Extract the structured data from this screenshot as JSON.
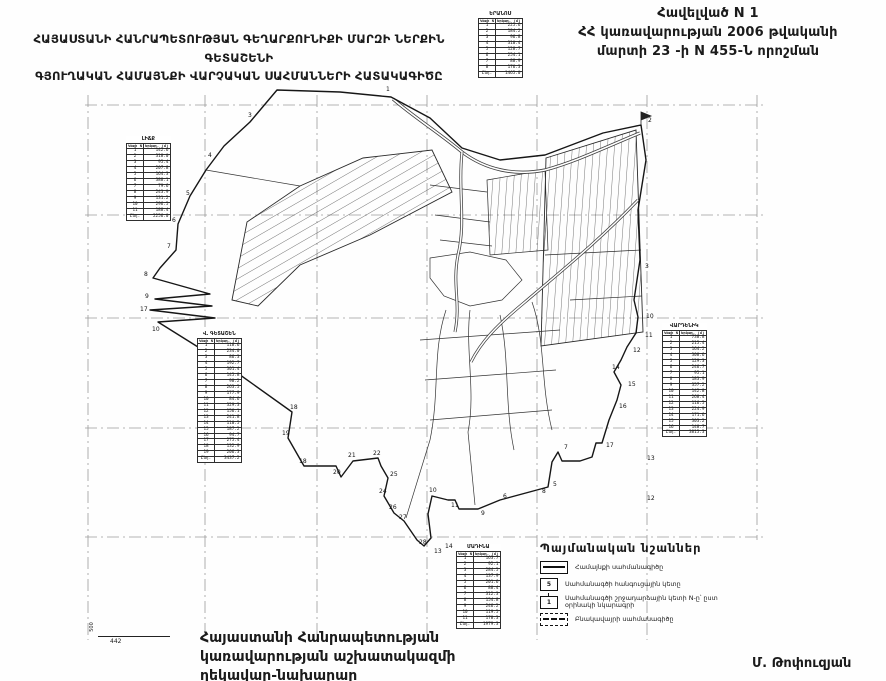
{
  "appendix": {
    "line1": "Հավելված N 1",
    "line2": "ՀՀ կառավարության 2006 թվականի",
    "line3": "մարտի 23 -ի N 455-Ն որոշման"
  },
  "title": {
    "line1": "ՀԱՅԱՍՏԱՆԻ ՀԱՆՐԱՊԵՏՈՒԹՅԱՆ ԳԵՂԱՐՔՈՒՆԻՔԻ ՄԱՐԶԻ ՆԵՐՔԻՆ ԳԵՏԱՇԵՆԻ",
    "line2": "ԳՅՈՒՂԱԿԱՆ ՀԱՄԱՅՆՔԻ ՎԱՐՉԱԿԱՆ  ՍԱՀՄԱՆՆԵՐԻ ՀԱՏԱԿԱԳԻԾԸ"
  },
  "issuer": {
    "line1": "Հայաստանի Հանրապետության",
    "line2": "կառավարության աշխատակազմի",
    "line3": "ղեկավար-նախարար"
  },
  "signature": "Մ. Թոփուզյան",
  "scale": {
    "left_label": "500",
    "bottom_label": "442"
  },
  "legend": {
    "title": "Պայմանական նշաններ",
    "items": [
      {
        "symbol": "boundary-line",
        "sym_text": "",
        "label": "Համայնքի սահմանագիծը"
      },
      {
        "symbol": "node-point",
        "sym_text": "5",
        "label": "Սահմանագծի հանգուցային կետը"
      },
      {
        "symbol": "turn-point",
        "sym_text": "1",
        "label": "Սահմանագծի շրջադարձային կետի N-ը՝ ըստ օրինակի նկարագրի"
      },
      {
        "symbol": "settlement-line",
        "sym_text": "",
        "label": "Բնակավայրի սահմանագիծը"
      }
    ]
  },
  "tables": [
    {
      "id": "north",
      "x": 478,
      "y": 11,
      "title": "ԵՐԱՆՈՍ",
      "col1": "Կետի N",
      "col2": "Երկար. (մ)",
      "rows": [
        [
          "1",
          "225.6"
        ],
        [
          "2",
          "184.2"
        ],
        [
          "3",
          "96.8"
        ],
        [
          "4",
          "310.4"
        ],
        [
          "5",
          "128.7"
        ],
        [
          "6",
          "254.1"
        ],
        [
          "7",
          "88.9"
        ],
        [
          "8",
          "176.3"
        ],
        [
          "Ընդ.",
          "1465.0"
        ]
      ]
    },
    {
      "id": "west",
      "x": 126,
      "y": 136,
      "title": "ԼԻՃՔ",
      "col1": "Կետի N",
      "col2": "Երկար. (մ)",
      "rows": [
        [
          "1",
          "142.6"
        ],
        [
          "2",
          "318.0"
        ],
        [
          "3",
          "95.4"
        ],
        [
          "4",
          "207.8"
        ],
        [
          "5",
          "164.3"
        ],
        [
          "6",
          "388.1"
        ],
        [
          "7",
          "79.6"
        ],
        [
          "8",
          "243.9"
        ],
        [
          "9",
          "131.2"
        ],
        [
          "10",
          "296.5"
        ],
        [
          "11",
          "188.4"
        ],
        [
          "Ընդ.",
          "2256.0"
        ]
      ]
    },
    {
      "id": "southwest",
      "x": 197,
      "y": 331,
      "title": "Վ. ԳԵՏԱՇԵՆ",
      "col1": "Կետի N",
      "col2": "Երկար. (մ)",
      "rows": [
        [
          "1",
          "118.6"
        ],
        [
          "2",
          "234.0"
        ],
        [
          "3",
          "86.3"
        ],
        [
          "4",
          "192.7"
        ],
        [
          "5",
          "301.4"
        ],
        [
          "6",
          "145.8"
        ],
        [
          "7",
          "98.2"
        ],
        [
          "8",
          "263.5"
        ],
        [
          "9",
          "177.9"
        ],
        [
          "10",
          "84.6"
        ],
        [
          "11",
          "329.3"
        ],
        [
          "12",
          "156.1"
        ],
        [
          "13",
          "241.8"
        ],
        [
          "14",
          "110.5"
        ],
        [
          "15",
          "187.2"
        ],
        [
          "16",
          "94.7"
        ],
        [
          "17",
          "275.4"
        ],
        [
          "18",
          "132.9"
        ],
        [
          "19",
          "206.3"
        ],
        [
          "Ընդ.",
          "3437.2"
        ]
      ]
    },
    {
      "id": "east",
      "x": 662,
      "y": 323,
      "title": "ՎԱՐԴԵՆԻԿ",
      "col1": "Կետի N",
      "col2": "Երկար. (մ)",
      "rows": [
        [
          "1",
          "738.8"
        ],
        [
          "2",
          "215.4"
        ],
        [
          "3",
          "164.2"
        ],
        [
          "4",
          "308.6"
        ],
        [
          "5",
          "129.3"
        ],
        [
          "6",
          "246.7"
        ],
        [
          "7",
          "95.1"
        ],
        [
          "8",
          "183.9"
        ],
        [
          "9",
          "357.2"
        ],
        [
          "10",
          "142.8"
        ],
        [
          "11",
          "268.4"
        ],
        [
          "12",
          "116.5"
        ],
        [
          "13",
          "224.9"
        ],
        [
          "14",
          "171.6"
        ],
        [
          "15",
          "303.2"
        ],
        [
          "16",
          "148.7"
        ],
        [
          "Ընդ.",
          "3815.3"
        ]
      ]
    },
    {
      "id": "south",
      "x": 456,
      "y": 544,
      "title": "ՄԱԴԻՆԱ",
      "col1": "Կետի N",
      "col2": "Երկար. (մ)",
      "rows": [
        [
          "1",
          "163.7"
        ],
        [
          "2",
          "92.1"
        ],
        [
          "3",
          "284.5"
        ],
        [
          "4",
          "137.9"
        ],
        [
          "5",
          "201.6"
        ],
        [
          "6",
          "88.4"
        ],
        [
          "7",
          "312.3"
        ],
        [
          "8",
          "154.8"
        ],
        [
          "9",
          "246.2"
        ],
        [
          "10",
          "119.5"
        ],
        [
          "11",
          "178.3"
        ],
        [
          "Ընդ.",
          "1979.3"
        ]
      ]
    }
  ],
  "map": {
    "point_labels": [
      {
        "x": 386,
        "y": 91,
        "t": "1"
      },
      {
        "x": 648,
        "y": 122,
        "t": "2"
      },
      {
        "x": 248,
        "y": 117,
        "t": "3"
      },
      {
        "x": 208,
        "y": 157,
        "t": "4"
      },
      {
        "x": 186,
        "y": 195,
        "t": "5"
      },
      {
        "x": 172,
        "y": 222,
        "t": "6"
      },
      {
        "x": 167,
        "y": 248,
        "t": "7"
      },
      {
        "x": 144,
        "y": 276,
        "t": "8"
      },
      {
        "x": 145,
        "y": 298,
        "t": "9"
      },
      {
        "x": 140,
        "y": 311,
        "t": "17"
      },
      {
        "x": 152,
        "y": 331,
        "t": "10"
      },
      {
        "x": 645,
        "y": 268,
        "t": "3"
      },
      {
        "x": 646,
        "y": 318,
        "t": "10"
      },
      {
        "x": 645,
        "y": 337,
        "t": "11"
      },
      {
        "x": 633,
        "y": 352,
        "t": "12"
      },
      {
        "x": 612,
        "y": 369,
        "t": "14"
      },
      {
        "x": 628,
        "y": 386,
        "t": "15"
      },
      {
        "x": 619,
        "y": 408,
        "t": "16"
      },
      {
        "x": 606,
        "y": 447,
        "t": "17"
      },
      {
        "x": 564,
        "y": 449,
        "t": "7"
      },
      {
        "x": 553,
        "y": 486,
        "t": "5"
      },
      {
        "x": 542,
        "y": 493,
        "t": "8"
      },
      {
        "x": 503,
        "y": 498,
        "t": "6"
      },
      {
        "x": 481,
        "y": 515,
        "t": "9"
      },
      {
        "x": 451,
        "y": 507,
        "t": "11"
      },
      {
        "x": 429,
        "y": 492,
        "t": "10"
      },
      {
        "x": 434,
        "y": 553,
        "t": "13"
      },
      {
        "x": 445,
        "y": 548,
        "t": "14"
      },
      {
        "x": 419,
        "y": 544,
        "t": "28"
      },
      {
        "x": 399,
        "y": 519,
        "t": "27"
      },
      {
        "x": 389,
        "y": 509,
        "t": "26"
      },
      {
        "x": 379,
        "y": 493,
        "t": "24"
      },
      {
        "x": 390,
        "y": 476,
        "t": "25"
      },
      {
        "x": 373,
        "y": 455,
        "t": "22"
      },
      {
        "x": 348,
        "y": 457,
        "t": "21"
      },
      {
        "x": 333,
        "y": 474,
        "t": "20"
      },
      {
        "x": 299,
        "y": 463,
        "t": "18"
      },
      {
        "x": 282,
        "y": 435,
        "t": "19"
      },
      {
        "x": 290,
        "y": 409,
        "t": "18"
      },
      {
        "x": 647,
        "y": 500,
        "t": "12"
      },
      {
        "x": 647,
        "y": 460,
        "t": "13"
      }
    ]
  }
}
